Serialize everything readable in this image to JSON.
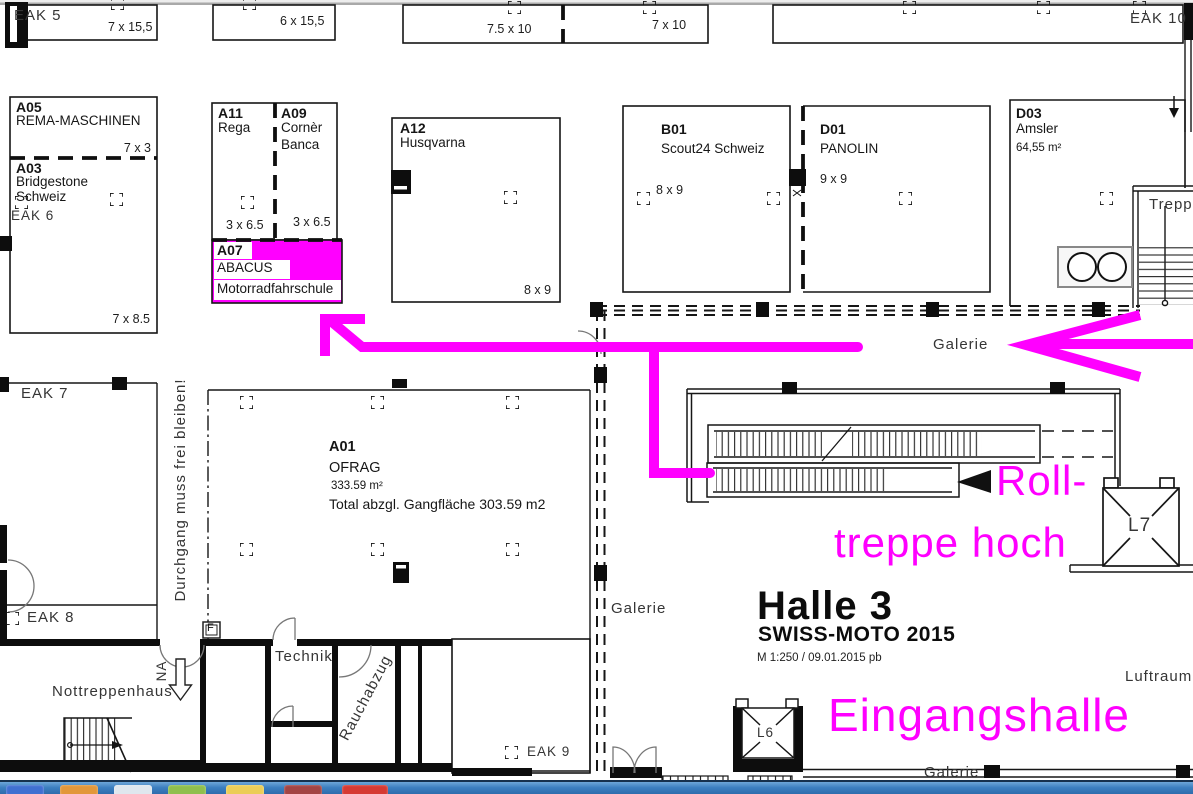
{
  "plan": {
    "top_row": {
      "eak5": {
        "code": "EAK 5",
        "size": "7 x 15,5"
      },
      "b6": {
        "size": "6 x 15,5"
      },
      "b75": {
        "size": "7.5 x 10"
      },
      "b7": {
        "size": "7 x 10"
      },
      "eak10": {
        "code": "EAK 10"
      }
    },
    "booths": {
      "a05": {
        "code": "A05",
        "name": "REMA-MASCHINEN",
        "size": "7 x 3"
      },
      "a03": {
        "code": "A03",
        "name_line1": "Bridgestone",
        "name_line2": "Schweiz",
        "eak": "EAK 6",
        "size": "7 x 8.5"
      },
      "a11": {
        "code": "A11",
        "name": "Rega",
        "size": "3 x 6.5"
      },
      "a09": {
        "code": "A09",
        "name_line1": "Cornèr",
        "name_line2": "Banca",
        "size": "3 x 6.5"
      },
      "a07": {
        "code": "A07",
        "name_line1": "ABACUS",
        "name_line2": "Motorradfahrschule",
        "highlight_color": "#FF00FF"
      },
      "a12": {
        "code": "A12",
        "name": "Husqvarna",
        "size": "8 x 9"
      },
      "b01": {
        "code": "B01",
        "name": "Scout24 Schweiz",
        "size": "8 x 9"
      },
      "d01": {
        "code": "D01",
        "name": "PANOLIN",
        "size": "9 x 9"
      },
      "d03": {
        "code": "D03",
        "name": "Amsler",
        "area": "64,55 m²"
      },
      "a01": {
        "code": "A01",
        "name": "OFRAG",
        "area": "333.59 m²",
        "note": "Total abzgl. Gangfläche 303.59 m2"
      }
    },
    "labels": {
      "eak7": "EAK 7",
      "eak8": "EAK 8",
      "eak9": "EAK 9",
      "treppe": "Treppe",
      "galerie": "Galerie",
      "luftraum": "Luftraum",
      "nottreppenhaus": "Nottreppenhaus",
      "technik": "Technik",
      "rauchabzug": "Rauchabzug",
      "na": "NA",
      "f": "F",
      "l6": "L6",
      "l7": "L7",
      "durchgang": "Durchgang muss frei bleiben!"
    },
    "title_block": {
      "hall": "Halle 3",
      "event": "SWISS-MOTO 2015",
      "meta": "M 1:250 / 09.01.2015 pb"
    },
    "annotations": {
      "color": "#FF00FF",
      "rolltreppe_line1": "Roll-",
      "rolltreppe_line2": "treppe hoch",
      "eingangshalle": "Eingangshalle"
    }
  },
  "taskbar": {
    "app_colors": [
      "#3f6fd1",
      "#e2973a",
      "#dfe7ee",
      "#8fbf4d",
      "#ebcd57",
      "#a34444",
      "#d63a33"
    ]
  }
}
